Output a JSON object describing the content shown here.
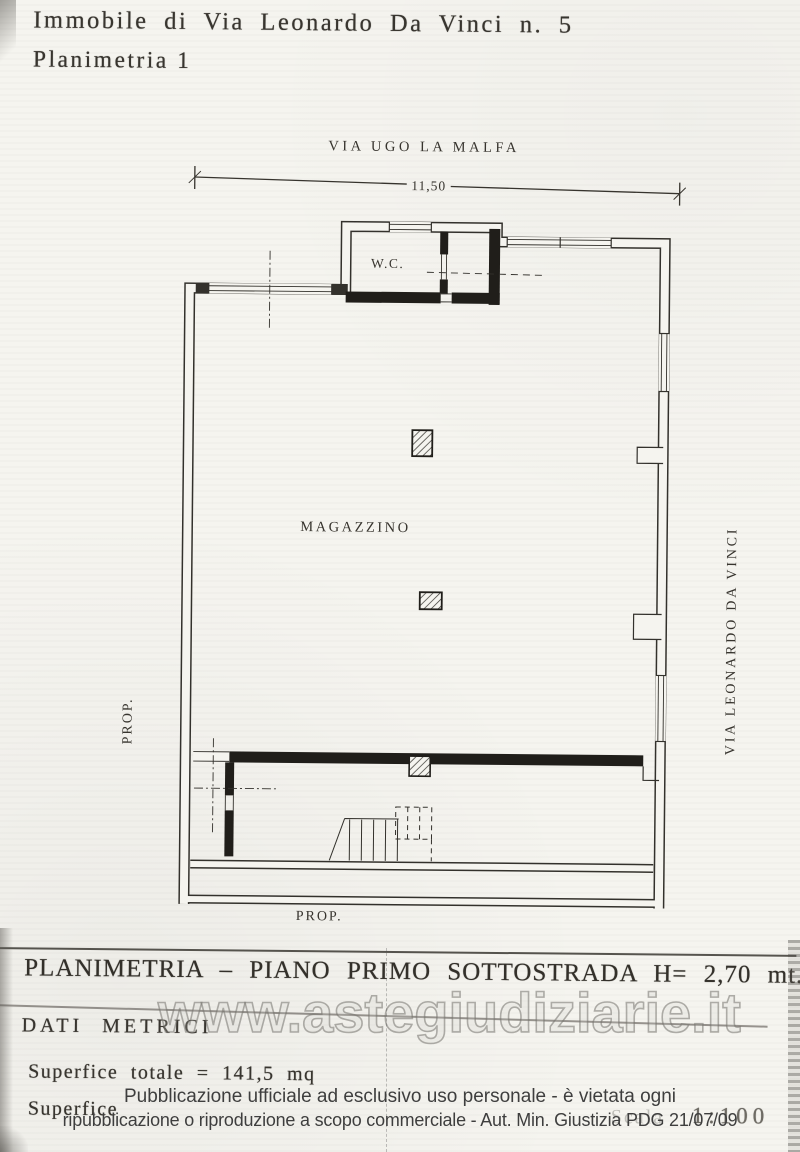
{
  "document": {
    "title_line1": "Immobile di Via Leonardo Da Vinci n. 5",
    "title_line2": "Planimetria 1"
  },
  "plan": {
    "street_top": "VIA UGO LA MALFA",
    "street_right": "VIA LEONARDO DA VINCI",
    "boundary_left": "PROP.",
    "boundary_bottom": "PROP.",
    "dimension_top": "11,50",
    "room_wc": "W.C.",
    "room_main": "MAGAZZINO"
  },
  "metrics": {
    "section_heading": "PLANIMETRIA – PIANO PRIMO SOTTOSTRADA H= 2,70 mt.",
    "subsection_heading": "DATI METRICI",
    "surface_total": "Superfice totale = 141,5 mq",
    "surface_partial": "Superfice",
    "scale_label": "Scala",
    "scale_value": "1:100"
  },
  "overlay": {
    "watermark": "www.astegiudiziarie.it",
    "disclaimer_line1": "Pubblicazione ufficiale ad esclusivo uso personale - è vietata ogni",
    "disclaimer_line2": "ripubblicazione o riproduzione a scopo commerciale - Aut. Min. Giustizia PDG 21/07/09"
  },
  "colors": {
    "ink": "#33312c",
    "paper": "#f5f4ef",
    "dark_wall": "#201e1a",
    "watermark_gray": "#7d7b77",
    "disclaimer_gray": "#3e3e3e"
  }
}
